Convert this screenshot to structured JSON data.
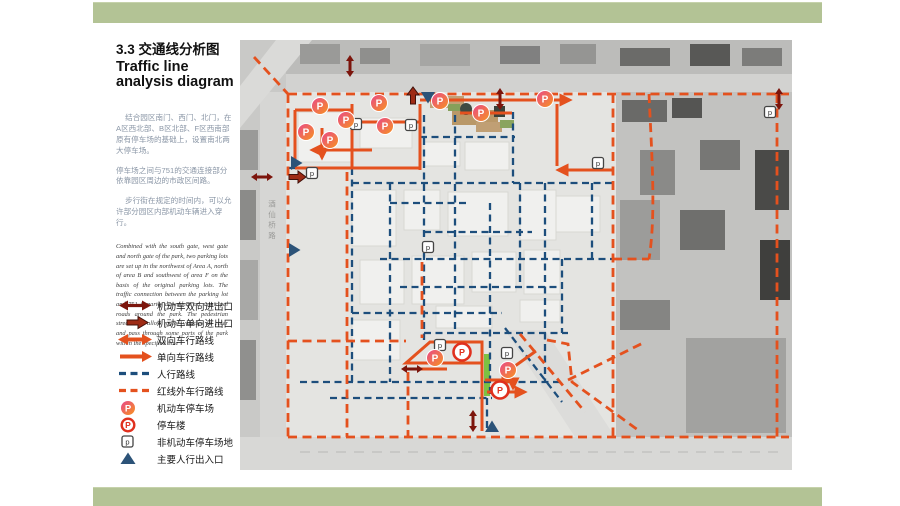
{
  "page": {
    "title_zh": "3.3 交通线分析图",
    "title_en": "Traffic line analysis diagram"
  },
  "description": {
    "paragraphs_zh": [
      "结合园区南门、西门、北门，在A区西北部、B区北部、F区西南部原有停车场的基础上，设置南北两大停车场。",
      "停车场之间与751的交通连接部分依靠园区周边的市政区间路。",
      "步行街在规定的时间内，可以允许部分园区内部机动车辆进入穿行。"
    ],
    "paragraph_en_script": "Combined with the south gate, west gate and north gate of the park, two parking lots are set up in the northwest of Area A, north of area B and southwest of area F on the basis of the original parking lots. The traffic connection between the parking lot and 751 is partly dependent on municipal roads around the park. The pedestrian street may allow motor vehicles to enter and pass through some parts of the park within the specified time"
  },
  "legend": {
    "items": [
      {
        "id": "two-way-access",
        "label": "机动车双向进出口"
      },
      {
        "id": "one-way-access",
        "label": "机动车单向进出口"
      },
      {
        "id": "two-way-route",
        "label": "双向车行路线"
      },
      {
        "id": "one-way-route",
        "label": "单向车行路线"
      },
      {
        "id": "pedestrian-route",
        "label": "人行路线"
      },
      {
        "id": "outside-redline-route",
        "label": "红线外车行路线"
      },
      {
        "id": "parking-lot",
        "label": "机动车停车场"
      },
      {
        "id": "parking-garage",
        "label": "停车楼"
      },
      {
        "id": "bike-parking",
        "label": "非机动车停车场地"
      },
      {
        "id": "main-ped-entrance",
        "label": "主要人行出入口"
      }
    ]
  },
  "map": {
    "road_label": "酒仙桥路",
    "glyphs": {
      "parking": "P",
      "bike_parking": "p"
    },
    "markers": {
      "parking_lots": [
        {
          "x": 320,
          "y": 106
        },
        {
          "x": 346,
          "y": 120
        },
        {
          "x": 306,
          "y": 132
        },
        {
          "x": 330,
          "y": 140
        },
        {
          "x": 379,
          "y": 103
        },
        {
          "x": 385,
          "y": 126
        },
        {
          "x": 440,
          "y": 101
        },
        {
          "x": 481,
          "y": 113
        },
        {
          "x": 545,
          "y": 99
        },
        {
          "x": 435,
          "y": 358
        },
        {
          "x": 508,
          "y": 370
        }
      ],
      "parking_garages": [
        {
          "x": 462,
          "y": 352
        },
        {
          "x": 500,
          "y": 390
        }
      ],
      "bike_parking": [
        {
          "x": 312,
          "y": 173
        },
        {
          "x": 356,
          "y": 124
        },
        {
          "x": 411,
          "y": 125
        },
        {
          "x": 428,
          "y": 247
        },
        {
          "x": 598,
          "y": 163
        },
        {
          "x": 770,
          "y": 112
        },
        {
          "x": 440,
          "y": 345
        },
        {
          "x": 507,
          "y": 353
        }
      ],
      "pedestrian_entrances": [
        {
          "x": 428,
          "y": 97,
          "dir": "down"
        },
        {
          "x": 296,
          "y": 163,
          "dir": "right"
        },
        {
          "x": 294,
          "y": 250,
          "dir": "right"
        },
        {
          "x": 492,
          "y": 427,
          "dir": "up"
        }
      ],
      "two_way_access": [
        {
          "x": 350,
          "y": 66,
          "orient": "v"
        },
        {
          "x": 500,
          "y": 99,
          "orient": "v"
        },
        {
          "x": 779,
          "y": 99,
          "orient": "v"
        },
        {
          "x": 262,
          "y": 177,
          "orient": "h"
        },
        {
          "x": 412,
          "y": 369,
          "orient": "h"
        },
        {
          "x": 473,
          "y": 421,
          "orient": "v"
        }
      ],
      "one_way_access": [
        {
          "x": 297,
          "y": 177,
          "dir": "right"
        },
        {
          "x": 413,
          "y": 96,
          "dir": "up"
        }
      ]
    }
  },
  "colors": {
    "band_green": "#B3C395",
    "route_orange": "#E4511E",
    "pedestrian_navy": "#1D4E7C",
    "access_dark_red": "#7C150C",
    "parking_gradient_start": "#E8478B",
    "parking_gradient_end": "#F7941E",
    "garage_ring_red": "#E0301E",
    "pedestrian_street_green": "#7DC242"
  }
}
